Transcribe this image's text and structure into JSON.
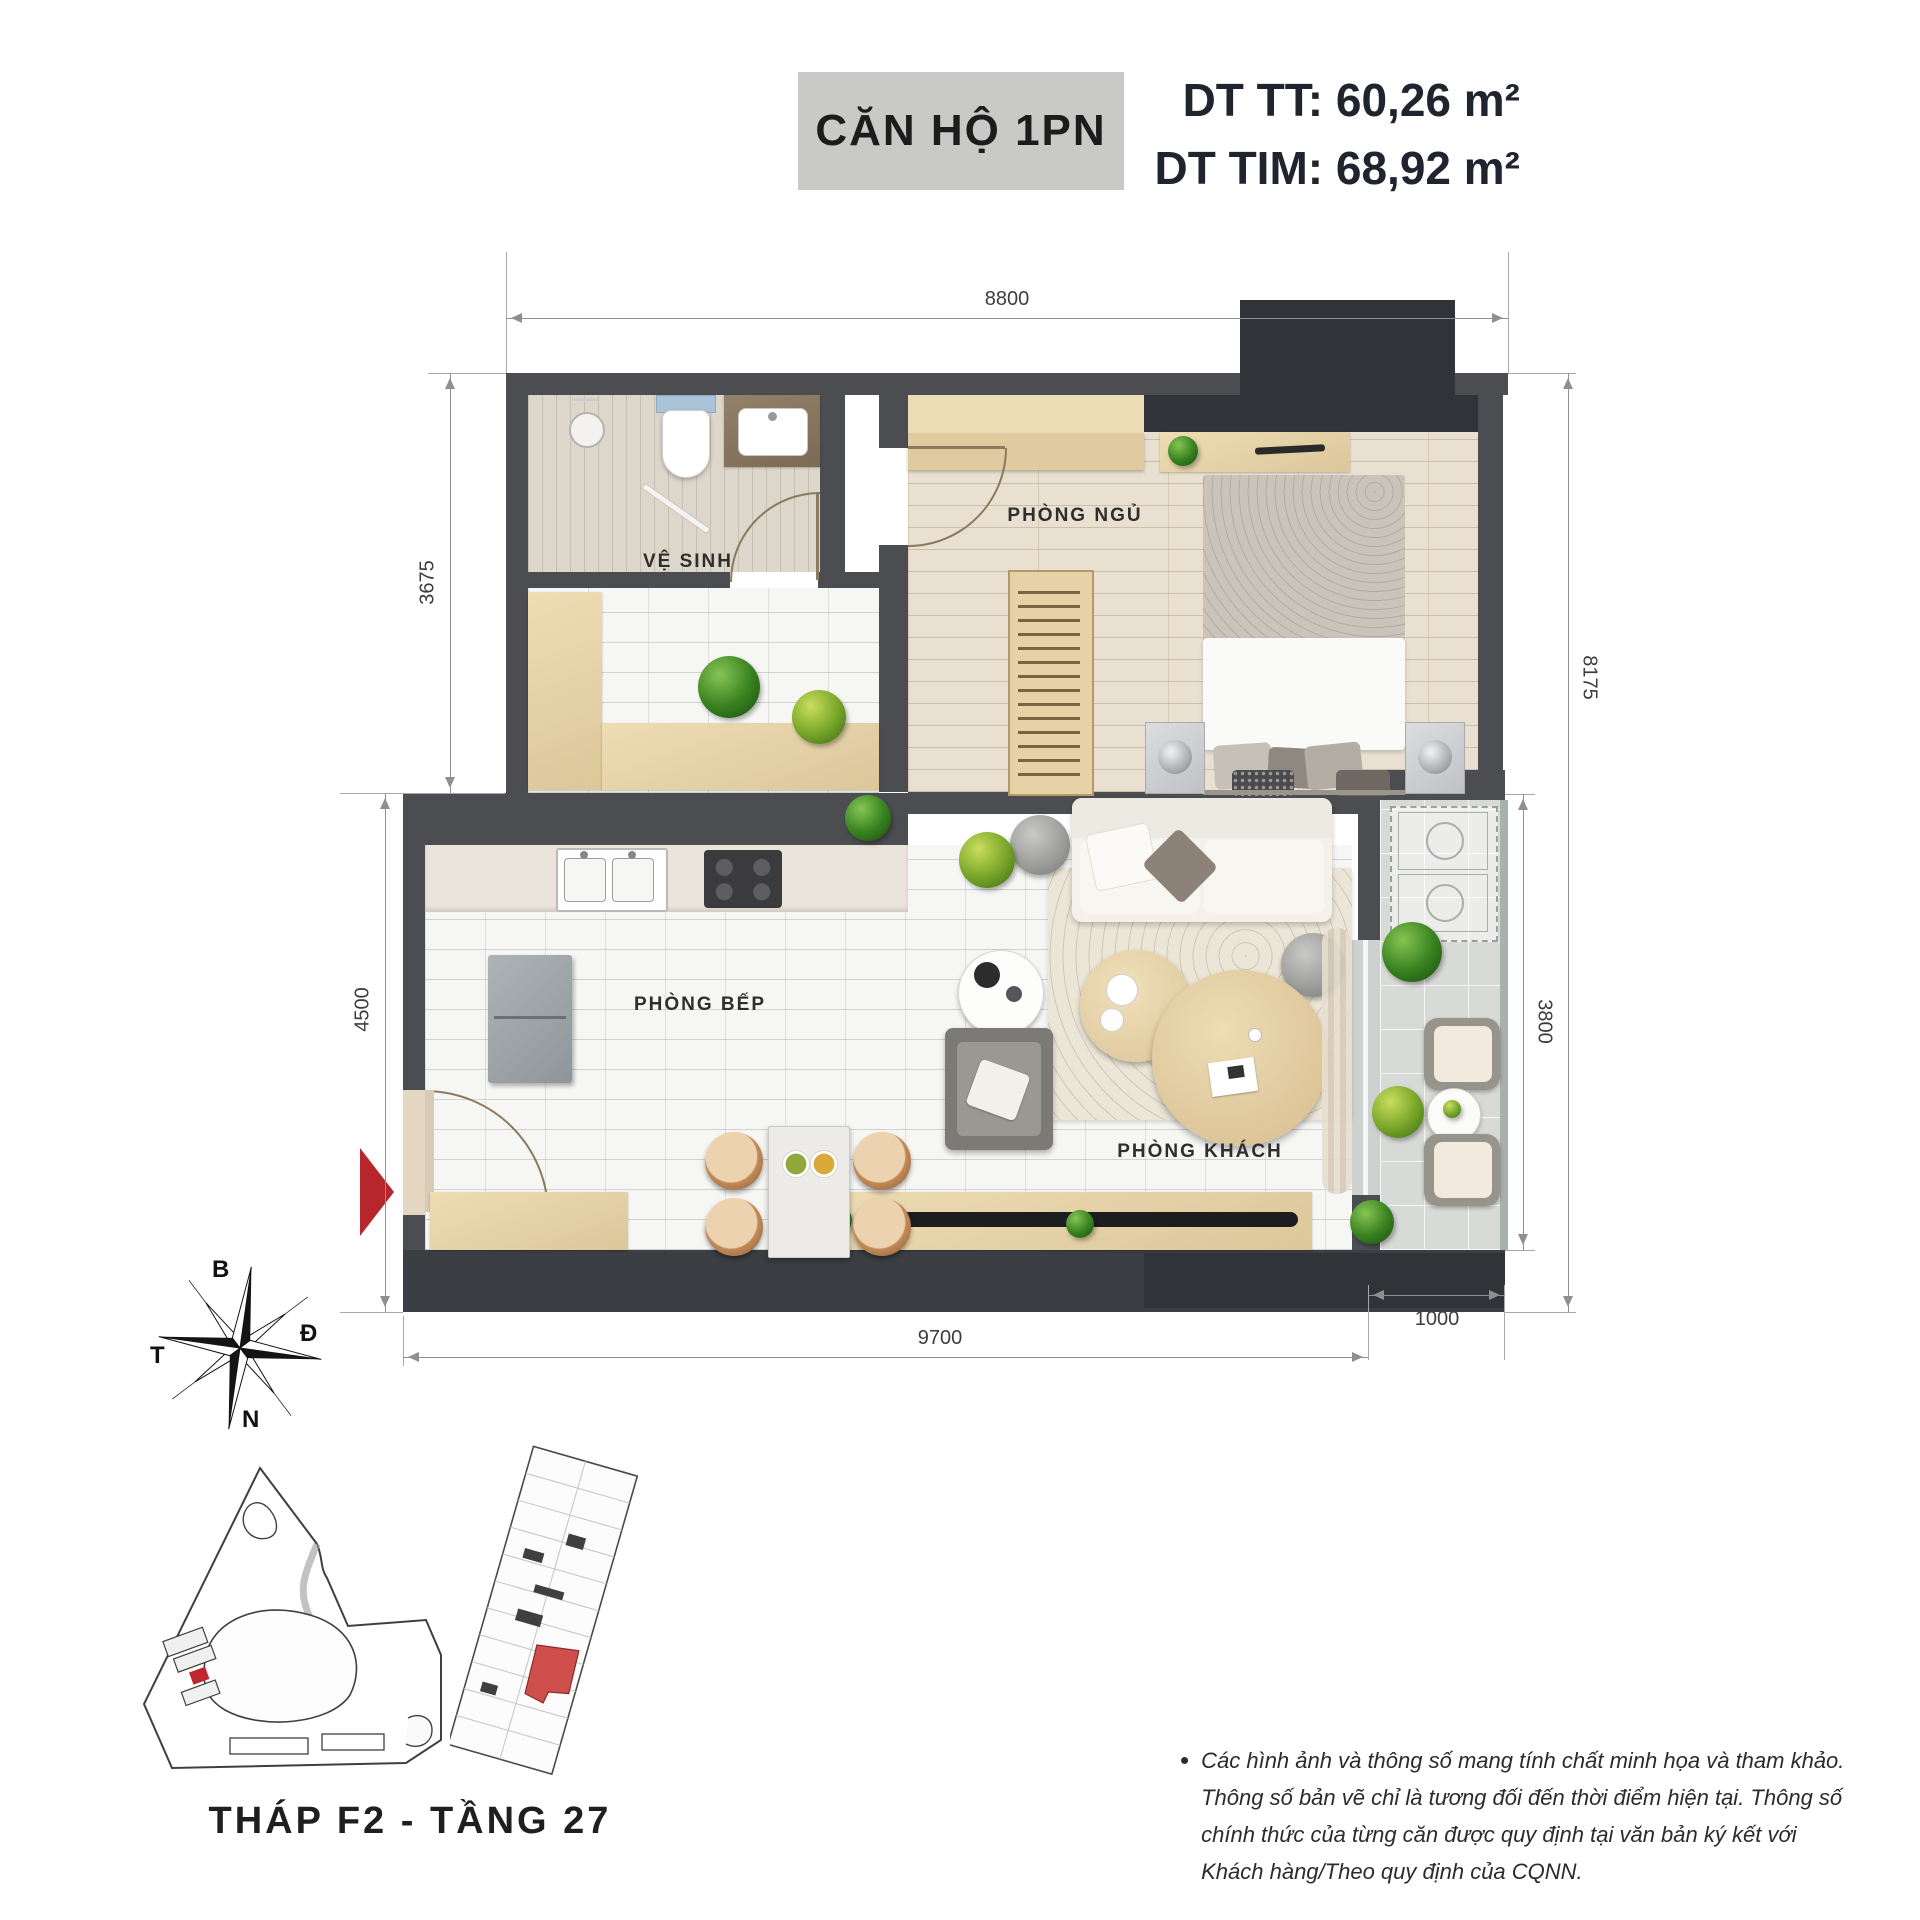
{
  "header": {
    "unit_badge": "CĂN HỘ 1PN",
    "area_tt": "DT TT: 60,26 m²",
    "area_tim": "DT TIM: 68,92 m²",
    "badge_bg": "#c9c9c8",
    "area_text_color": "#20242e"
  },
  "plan": {
    "room_labels": {
      "bathroom": "VỆ SINH",
      "bedroom": "PHÒNG NGỦ",
      "kitchen": "PHÒNG BẾP",
      "living": "PHÒNG KHÁCH"
    },
    "dimensions": {
      "top": "8800",
      "left_upper": "3675",
      "left_lower": "4500",
      "right_outer": "8175",
      "right_inner": "3800",
      "bottom": "9700",
      "bottom_right": "1000"
    },
    "colors": {
      "wall": "#4b4d50",
      "wall_dark": "#303338",
      "entrance_arrow": "#b5272c",
      "unit_highlight": "#cf4f4d"
    }
  },
  "compass": {
    "north": "B",
    "east": "Đ",
    "south": "N",
    "west": "T"
  },
  "footer": {
    "tower_floor_label": "THÁP F2 - TẦNG 27",
    "bullet": "•",
    "disclaimer_lines": [
      "Các hình ảnh và thông số mang tính chất minh họa và tham khảo.",
      "Thông số bản vẽ chỉ là tương đối đến thời điểm hiện tại. Thông số",
      "chính thức của từng căn được quy định tại văn bản ký kết với",
      "Khách hàng/Theo quy định của CQNN."
    ]
  }
}
